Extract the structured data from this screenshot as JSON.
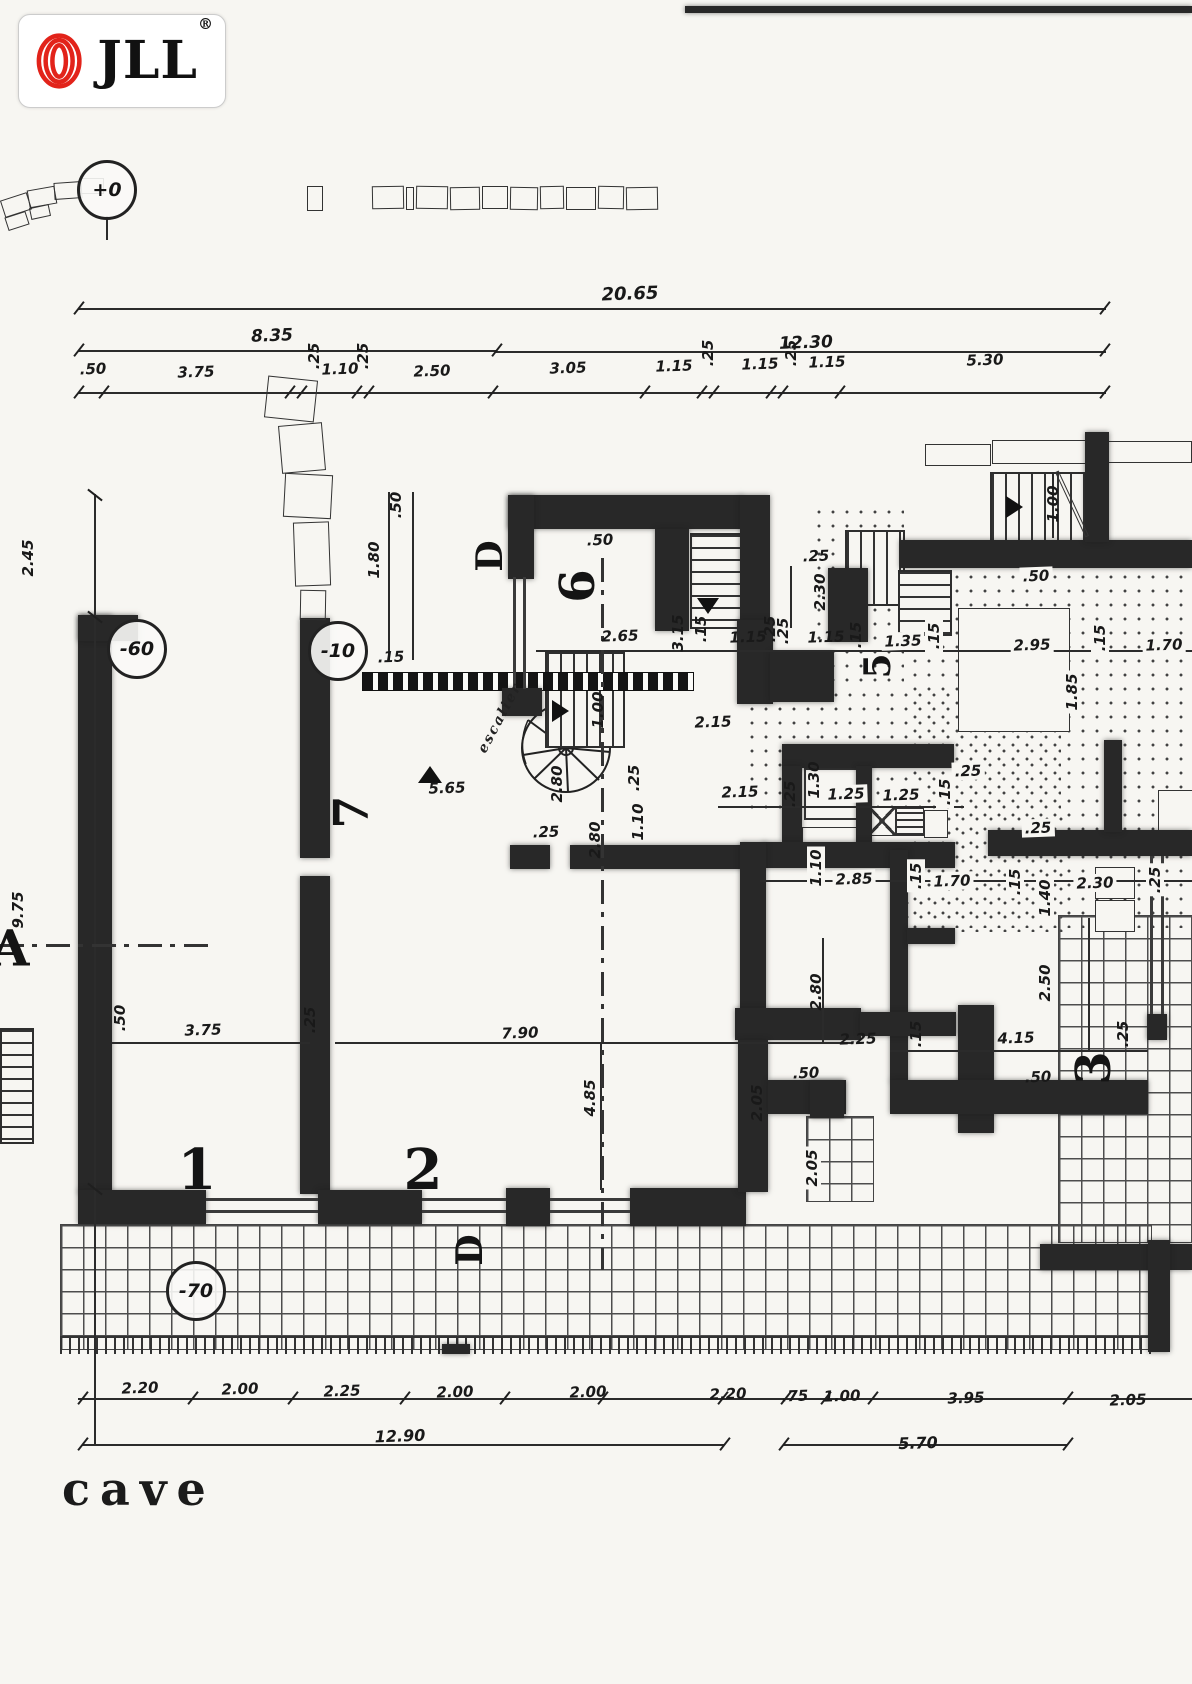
{
  "logo": {
    "brand": "JLL",
    "registered": "®"
  },
  "plan_title": "cave",
  "colors": {
    "logo_red": "#e2231a",
    "ink": "#1c1c1c",
    "paper": "#f7f6f2"
  },
  "level_markers": [
    {
      "t": "+0",
      "x": 107,
      "y": 190
    },
    {
      "t": "-60",
      "x": 137,
      "y": 649
    },
    {
      "t": "-10",
      "x": 338,
      "y": 651
    },
    {
      "t": "-70",
      "x": 196,
      "y": 1291
    }
  ],
  "axis_labels": [
    {
      "t": "A",
      "x": 10,
      "y": 948,
      "s": 50
    },
    {
      "t": "D",
      "x": 490,
      "y": 556,
      "s": 36,
      "r": 1
    },
    {
      "t": "D",
      "x": 470,
      "y": 1250,
      "s": 36,
      "r": 1
    }
  ],
  "room_numbers": [
    {
      "t": "1",
      "x": 197,
      "y": 1170,
      "s": 56
    },
    {
      "t": "2",
      "x": 423,
      "y": 1170,
      "s": 56
    },
    {
      "t": "3",
      "x": 1094,
      "y": 1068,
      "s": 48,
      "r": 1
    },
    {
      "t": "5",
      "x": 878,
      "y": 666,
      "s": 36,
      "r": 1
    },
    {
      "t": "6",
      "x": 578,
      "y": 586,
      "s": 48,
      "r": 1
    },
    {
      "t": "7",
      "x": 352,
      "y": 812,
      "s": 48,
      "r": 1
    }
  ],
  "annotations": [
    {
      "t": "escalier",
      "x": 500,
      "y": 718,
      "rot": -62
    }
  ],
  "dimensions": {
    "top": [
      {
        "t": "20.65",
        "x": 630,
        "y": 294,
        "s": 18
      },
      {
        "t": "8.35",
        "x": 272,
        "y": 336,
        "s": 17
      },
      {
        "t": "12.30",
        "x": 806,
        "y": 343,
        "s": 17
      },
      {
        "t": ".50",
        "x": 93,
        "y": 369
      },
      {
        "t": "3.75",
        "x": 196,
        "y": 372
      },
      {
        "t": ".25",
        "x": 314,
        "y": 356,
        "r": 1
      },
      {
        "t": "1.10",
        "x": 340,
        "y": 369
      },
      {
        "t": ".25",
        "x": 363,
        "y": 356,
        "r": 1
      },
      {
        "t": "2.50",
        "x": 432,
        "y": 371
      },
      {
        "t": "3.05",
        "x": 568,
        "y": 368
      },
      {
        "t": "1.15",
        "x": 674,
        "y": 366
      },
      {
        "t": ".25",
        "x": 708,
        "y": 353,
        "r": 1
      },
      {
        "t": "1.15",
        "x": 760,
        "y": 364
      },
      {
        "t": ".25",
        "x": 791,
        "y": 353,
        "r": 1
      },
      {
        "t": "1.15",
        "x": 827,
        "y": 362
      },
      {
        "t": "5.30",
        "x": 985,
        "y": 360
      }
    ],
    "left": [
      {
        "t": "2.45",
        "x": 28,
        "y": 558,
        "r": 1
      },
      {
        "t": "9.75",
        "x": 18,
        "y": 910,
        "r": 1
      }
    ],
    "bottom": [
      {
        "t": "2.20",
        "x": 140,
        "y": 1388
      },
      {
        "t": "2.00",
        "x": 240,
        "y": 1389
      },
      {
        "t": "2.25",
        "x": 342,
        "y": 1391
      },
      {
        "t": "2.00",
        "x": 455,
        "y": 1392
      },
      {
        "t": "2.00",
        "x": 588,
        "y": 1392
      },
      {
        "t": "2.20",
        "x": 728,
        "y": 1394
      },
      {
        "t": ".75",
        "x": 795,
        "y": 1396
      },
      {
        "t": "1.00",
        "x": 842,
        "y": 1396
      },
      {
        "t": "3.95",
        "x": 966,
        "y": 1398
      },
      {
        "t": "2.05",
        "x": 1128,
        "y": 1400
      },
      {
        "t": "12.90",
        "x": 400,
        "y": 1436,
        "s": 16
      },
      {
        "t": "5.70",
        "x": 918,
        "y": 1443,
        "s": 16
      }
    ],
    "interior": [
      {
        "t": ".50",
        "x": 600,
        "y": 540
      },
      {
        "t": "2.65",
        "x": 620,
        "y": 636
      },
      {
        "t": "3.15",
        "x": 678,
        "y": 633,
        "r": 1
      },
      {
        "t": ".15",
        "x": 701,
        "y": 629,
        "r": 1
      },
      {
        "t": ".50",
        "x": 396,
        "y": 505,
        "r": 1
      },
      {
        "t": "1.80",
        "x": 374,
        "y": 560,
        "r": 1
      },
      {
        "t": ".15",
        "x": 391,
        "y": 657
      },
      {
        "t": ".25",
        "x": 770,
        "y": 629,
        "r": 1
      },
      {
        "t": "1.15",
        "x": 748,
        "y": 637
      },
      {
        "t": ".25",
        "x": 783,
        "y": 631,
        "r": 1
      },
      {
        "t": "1.15",
        "x": 826,
        "y": 637
      },
      {
        "t": ".15",
        "x": 856,
        "y": 635,
        "r": 1
      },
      {
        "t": "1.35",
        "x": 903,
        "y": 641,
        "b": 1
      },
      {
        "t": ".15",
        "x": 934,
        "y": 636,
        "r": 1,
        "b": 1
      },
      {
        "t": "2.95",
        "x": 1032,
        "y": 645,
        "b": 1
      },
      {
        "t": ".15",
        "x": 1100,
        "y": 638,
        "r": 1,
        "b": 1
      },
      {
        "t": "1.70",
        "x": 1164,
        "y": 645,
        "b": 1
      },
      {
        "t": "1.85",
        "x": 1072,
        "y": 692,
        "r": 1,
        "b": 1
      },
      {
        "t": ".25",
        "x": 816,
        "y": 556
      },
      {
        "t": "2.30",
        "x": 820,
        "y": 592,
        "r": 1
      },
      {
        "t": ".50",
        "x": 1036,
        "y": 576,
        "b": 1
      },
      {
        "t": "1.00",
        "x": 1053,
        "y": 504,
        "r": 1
      },
      {
        "t": ".25",
        "x": 968,
        "y": 771,
        "b": 1
      },
      {
        "t": "5.65",
        "x": 447,
        "y": 788
      },
      {
        "t": "1.00",
        "x": 598,
        "y": 710,
        "r": 1
      },
      {
        "t": ".25",
        "x": 634,
        "y": 778,
        "r": 1
      },
      {
        "t": "2.80",
        "x": 557,
        "y": 784,
        "r": 1
      },
      {
        "t": "2.80",
        "x": 595,
        "y": 840,
        "r": 1
      },
      {
        "t": "1.10",
        "x": 638,
        "y": 822,
        "r": 1
      },
      {
        "t": ".25",
        "x": 546,
        "y": 832
      },
      {
        "t": "2.15",
        "x": 713,
        "y": 722
      },
      {
        "t": "2.15",
        "x": 740,
        "y": 792,
        "b": 1
      },
      {
        "t": ".25",
        "x": 790,
        "y": 794,
        "r": 1
      },
      {
        "t": "1.30",
        "x": 814,
        "y": 780,
        "r": 1
      },
      {
        "t": "1.25",
        "x": 846,
        "y": 794,
        "b": 1
      },
      {
        "t": "1.25",
        "x": 901,
        "y": 795,
        "b": 1
      },
      {
        "t": ".15",
        "x": 945,
        "y": 792,
        "r": 1,
        "b": 1
      },
      {
        "t": "1.10",
        "x": 816,
        "y": 868,
        "r": 1,
        "b": 1
      },
      {
        "t": "2.85",
        "x": 854,
        "y": 879,
        "b": 1
      },
      {
        "t": ".15",
        "x": 916,
        "y": 876,
        "r": 1,
        "b": 1
      },
      {
        "t": "1.70",
        "x": 952,
        "y": 881,
        "b": 1
      },
      {
        "t": ".15",
        "x": 1015,
        "y": 882,
        "r": 1,
        "b": 1
      },
      {
        "t": "1.40",
        "x": 1045,
        "y": 898,
        "r": 1,
        "b": 1
      },
      {
        "t": "2.30",
        "x": 1095,
        "y": 883,
        "b": 1
      },
      {
        "t": ".25",
        "x": 1155,
        "y": 880,
        "r": 1,
        "b": 1
      },
      {
        "t": ".25",
        "x": 1038,
        "y": 828,
        "b": 1
      },
      {
        "t": ".50",
        "x": 120,
        "y": 1018,
        "r": 1
      },
      {
        "t": "3.75",
        "x": 203,
        "y": 1030
      },
      {
        "t": ".25",
        "x": 310,
        "y": 1020,
        "r": 1
      },
      {
        "t": "7.90",
        "x": 520,
        "y": 1033
      },
      {
        "t": "4.85",
        "x": 590,
        "y": 1098,
        "r": 1
      },
      {
        "t": "2.80",
        "x": 816,
        "y": 992,
        "r": 1
      },
      {
        "t": "2.25",
        "x": 858,
        "y": 1039
      },
      {
        "t": ".50",
        "x": 806,
        "y": 1073
      },
      {
        "t": "2.50",
        "x": 1045,
        "y": 983,
        "r": 1
      },
      {
        "t": ".15",
        "x": 916,
        "y": 1034,
        "r": 1
      },
      {
        "t": "4.15",
        "x": 1016,
        "y": 1038
      },
      {
        "t": ".25",
        "x": 1123,
        "y": 1034,
        "r": 1
      },
      {
        "t": ".50",
        "x": 1038,
        "y": 1077
      },
      {
        "t": "2.05",
        "x": 757,
        "y": 1103,
        "r": 1
      },
      {
        "t": "2.05",
        "x": 812,
        "y": 1168,
        "r": 1,
        "b": 1
      }
    ]
  }
}
